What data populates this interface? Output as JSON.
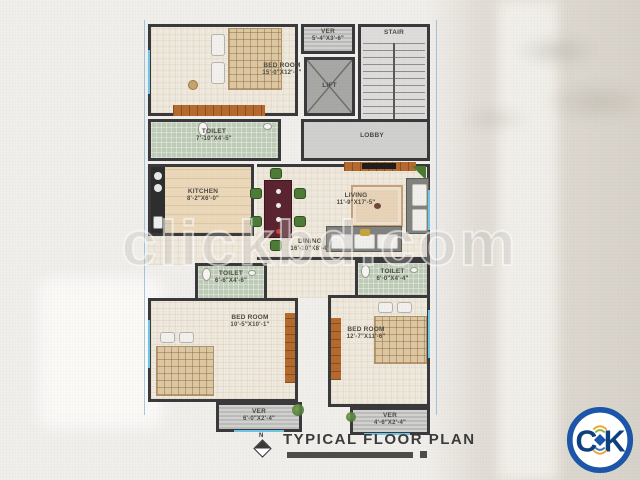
{
  "watermark": {
    "text": "clickbd.com"
  },
  "footer": {
    "title": "TYPICAL FLOOR PLAN",
    "north_label": "N"
  },
  "logo": {
    "letter_left": "C",
    "letter_right": "K"
  },
  "plan": {
    "rooms": {
      "bedroom_tl": {
        "name": "BED ROOM",
        "dims": "15'-0\"X12'-1\""
      },
      "ver_top": {
        "name": "VER",
        "dims": "5'-4\"X3'-6\""
      },
      "lift": {
        "name": "LIFT"
      },
      "stair": {
        "name": "STAIR"
      },
      "lobby": {
        "name": "LOBBY"
      },
      "toilet_top": {
        "name": "TOILET",
        "dims": "7'-10\"X4'-5\""
      },
      "kitchen": {
        "name": "KITCHEN",
        "dims": "8'-2\"X6'-0\""
      },
      "dining": {
        "name": "DINING",
        "dims": "16'-10\"X8'-4\""
      },
      "living": {
        "name": "LIVING",
        "dims": "11'-9\"X17'-5\""
      },
      "toilet_bl": {
        "name": "TOILET",
        "dims": "6'-6\"X4'-6\""
      },
      "toilet_br": {
        "name": "TOILET",
        "dims": "6'-0\"X4'-4\""
      },
      "bedroom_bl": {
        "name": "BED ROOM",
        "dims": "10'-5\"X10'-1\""
      },
      "bedroom_br": {
        "name": "BED ROOM",
        "dims": "12'-7\"X11'-6\""
      },
      "ver_bl": {
        "name": "VER",
        "dims": "6'-0\"X2'-4\""
      },
      "ver_br": {
        "name": "VER",
        "dims": "4'-6\"X2'-4\""
      }
    }
  },
  "colors": {
    "wall": "#3a3a3c",
    "accent_wood": "#b66a2e",
    "toilet_floor": "#bfccb7",
    "window": "#6fc4e4",
    "logo_blue": "#1c56a8"
  }
}
